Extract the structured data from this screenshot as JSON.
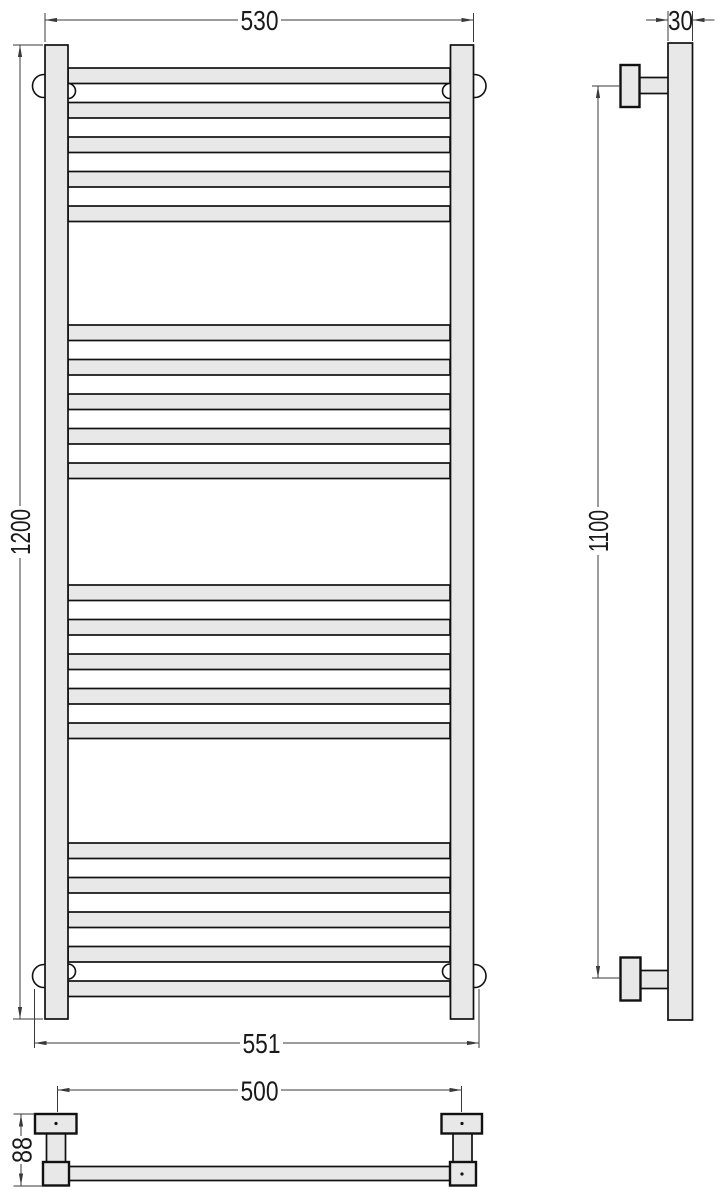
{
  "drawing": {
    "type": "towel-rail-technical-drawing",
    "dimensions": {
      "front_width_top": "530",
      "front_height": "1200",
      "front_width_bottom": "551",
      "side_depth": "30",
      "side_mount_height": "1100",
      "plan_mount_width": "500",
      "plan_depth": "88"
    },
    "colors": {
      "fill": "#e8e8e8",
      "outline": "#111111",
      "dimension": "#3a3a3a",
      "text": "#1a1a1a",
      "background": "#ffffff"
    },
    "rungs": {
      "groups": 4,
      "per_group": 5,
      "group_starts_y": [
        68,
        325,
        585,
        843
      ],
      "pitch": 34.5,
      "height": 15.5,
      "x": 68,
      "width": 382
    }
  }
}
